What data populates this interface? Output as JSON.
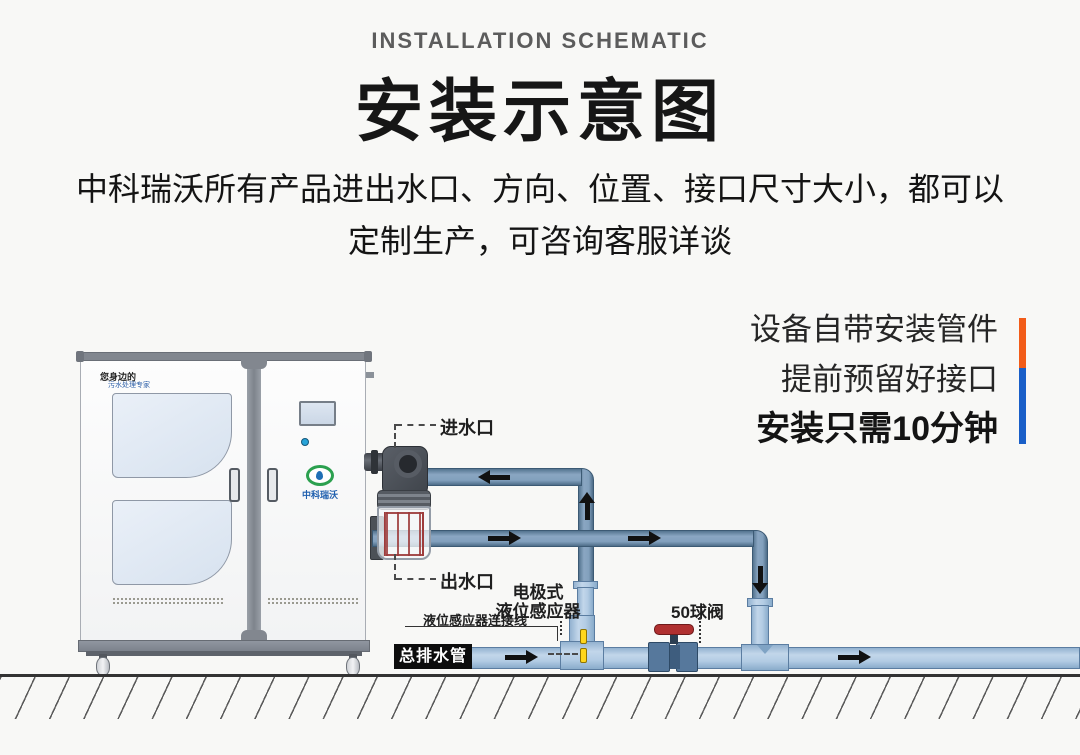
{
  "header": {
    "eyebrow": "INSTALLATION SCHEMATIC",
    "title": "安装示意图",
    "subtitle_line1": "中科瑞沃所有产品进出水口、方向、位置、接口尺寸大小，都可以",
    "subtitle_line2": "定制生产，可咨询客服详谈"
  },
  "promo": {
    "line1": "设备自带安装管件",
    "line2": "提前预留好接口",
    "line3": "安装只需10分钟",
    "bar_top_color": "#f25c19",
    "bar_bottom_color": "#1a5fc8"
  },
  "machine": {
    "tagline_line1": "您身边的",
    "tagline_line2": "污水处理专家",
    "logo_text": "中科瑞沃"
  },
  "diagram": {
    "labels": {
      "inlet": "进水口",
      "outlet": "出水口",
      "sensor_line1": "电极式",
      "sensor_line2": "液位感应器",
      "sensor_cable": "液位感应器连接线",
      "ball_valve": "50球阀",
      "main_drain": "总排水管"
    },
    "colors": {
      "pipe_dark": "#82a0bd",
      "pipe_light": "#b3cce4",
      "valve_red": "#b03030",
      "electrode_yellow": "#ffd61c",
      "drain_label_bg": "#0d0d0d"
    }
  }
}
